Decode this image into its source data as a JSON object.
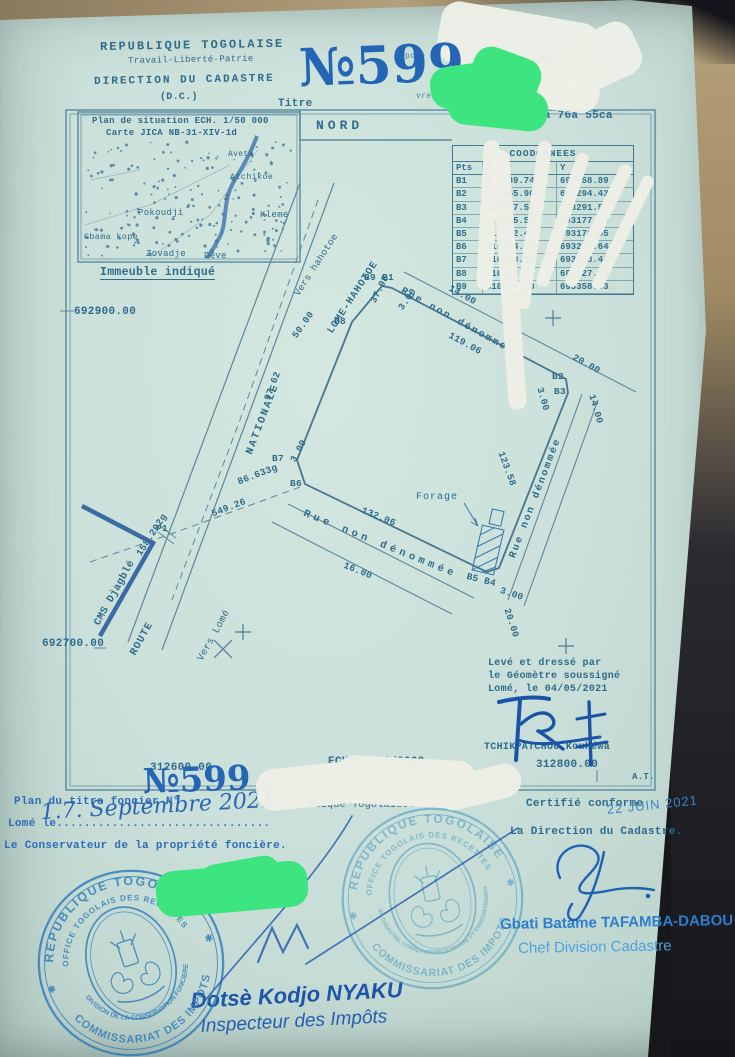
{
  "doc": {
    "header": {
      "republic": "REPUBLIQUE TOGOLAISE",
      "motto": "Travail-Liberté-Patrie",
      "direction": "DIRECTION DU CADASTRE",
      "dc": "(D.C.)",
      "titre_label": "Titre",
      "title_number_big": "№599",
      "frag_depose": "posé",
      "frag_livre": "vre",
      "right_number": "N° 65437",
      "togolaise_fragment": "togolaise.",
      "area": "1ha 76a 55ca"
    },
    "inset_map": {
      "line1": "Plan de situation ECH. 1/50 000",
      "line2": "Carte JICA NB-31-XIV-1d",
      "places": [
        "Aveta",
        "Atchikoe",
        "Pokoudji",
        "Kleme",
        "Gbama kope",
        "Zovadje",
        "Deve"
      ],
      "caption": "Immeuble indiqué"
    },
    "nord": "NORD",
    "coords": {
      "title": "COODONNEES",
      "headers": [
        "Pts",
        "X",
        "Y"
      ],
      "rows": [
        [
          "B1",
          "310589.74",
          "693358.89"
        ],
        [
          "B2",
          "310655.90",
          "693294.43"
        ],
        [
          "B3",
          "310647.50",
          "693291.57"
        ],
        [
          "B4",
          "310605.52",
          "693177.14"
        ],
        [
          "B5",
          "310472.42",
          "693176.05"
        ],
        [
          "B6",
          "310424.90",
          "693236.64"
        ],
        [
          "B7",
          "310423.30",
          "693238.48"
        ],
        [
          "B8",
          "310564.73",
          "693327.93"
        ],
        [
          "B9",
          "310584.20",
          "693358.33"
        ]
      ]
    },
    "plan": {
      "grid_left_top": "692900.00",
      "grid_left_bottom": "692700.00",
      "grid_bottom_left": "312600.00",
      "grid_bottom_right": "312800.00",
      "scale": "ECHELLE:1/2000",
      "at": "A.T.",
      "roads": {
        "vers_hahotoe": "Vers hahotoe",
        "lome_hahotoe": "LOME-HAHOTOE",
        "nationale": "NATIONALE",
        "route": "ROUTE",
        "vers_lome": "Vers Lomé",
        "cms": "CMS Djagblé"
      },
      "rue1": "Rue non dénommée",
      "rue2": "Rue non dénommée",
      "rue3": "Rue non dénommée",
      "forage": "Forage",
      "points": {
        "b9b1": "B9 B1",
        "b8": "B8",
        "b7": "B7",
        "b6": "B6",
        "b5b4": "B5 B4",
        "b2": "B2",
        "b3": "B3",
        "p1": "P1"
      },
      "dims": [
        "37.98",
        "3.00",
        "119.06",
        "14.00",
        "20.00",
        "3.00",
        "14.00",
        "123.58",
        "97.62",
        "50.00",
        "3.00",
        "86.633g",
        "549.26",
        "158.202g",
        "132.06",
        "16.00",
        "3.00",
        "20.00"
      ],
      "surveyor": {
        "l1": "Levé et dressé par",
        "l2": "le Géomètre soussigné",
        "l3": "Lomé, le 04/05/2021",
        "name": "TCHIKPATCHOU Kouhéwa"
      }
    },
    "footer": {
      "plan_titre": "Plan du titre foncier N°",
      "big_number": "№599",
      "togolaise_fragment": "blique Togolaise.",
      "lome_le": "Lomé le...............................",
      "date_hand": "1.7. Septembre 2021",
      "conservateur": "Le Conservateur de la propriété foncière.",
      "certifie": "Certifié conforme",
      "date_stamp": "22 JUIN 2021",
      "direction": "La Direction du Cadastre.",
      "chef_name": "Gbati Batame TAFAMBA-DABOU",
      "chef_title": "Chef Division Cadastre",
      "inspecteur_name": "Dotsè Kodjo NYAKU",
      "inspecteur_title": "Inspecteur des Impôts"
    },
    "stamps": {
      "outer_top": "REPUBLIQUE TOGOLAISE",
      "outer_mid": "OFFICE TOGOLAIS DES RECETTES",
      "outer_bottom": "COMMISSARIAT DES IMPOTS",
      "inner1": "DIVISION DE LA CONSERVATION FONCIERE",
      "inner2": "DIR. CADASTRE, CONSERVATION FONCIERE ET ENREGISTREMENT",
      "star": "✱"
    },
    "colors": {
      "ink": "#2f6b8b",
      "hand_blue": "#2a66b4",
      "stamp_blue": "#2d7ab8",
      "green_redaction": "#3ce57f",
      "whiteout": "#edefe7",
      "paper": "#cbe0da"
    }
  }
}
